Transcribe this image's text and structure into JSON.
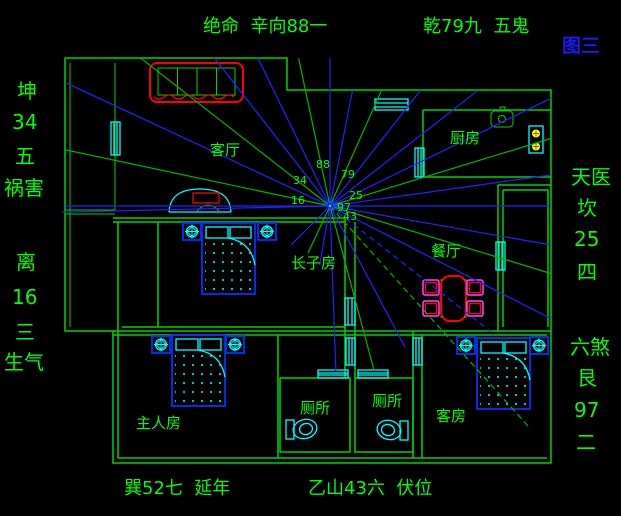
{
  "figure_tag": "图三",
  "annotations": {
    "top_left": "绝命  辛向88一",
    "top_right": "乾79九  五鬼",
    "left_top": [
      "坤",
      "34",
      "五",
      "祸害"
    ],
    "left_bottom": [
      "离",
      "16",
      "三",
      "生气"
    ],
    "right_top": [
      "天医",
      "坎",
      "25",
      "四"
    ],
    "right_bottom": [
      "六煞",
      "艮",
      "97",
      "二"
    ],
    "bottom_left": "巽52七  延年",
    "bottom_right": "乙山43六  伏位"
  },
  "rooms": {
    "living_room": "客厅",
    "kitchen": "厨房",
    "dining_room": "餐厅",
    "eldest_son_room": "长子房",
    "master_bedroom": "主人房",
    "toilet_left": "厕所",
    "toilet_right": "厕所",
    "guest_room": "客房"
  },
  "center_numbers": {
    "top": "88",
    "top_right": "79",
    "left_upper": "34",
    "right": "25",
    "left_lower": "16",
    "lower_right": "97",
    "bottom": "43"
  },
  "colors": {
    "background": "#000000",
    "wall_green": "#00d400",
    "text_green": "#00ff00",
    "ray_blue": "#2222ff",
    "ray_green": "#00b400",
    "furniture_blue": "#0033ff",
    "detail_cyan": "#00ffff",
    "accent_red": "#ff0000",
    "accent_magenta": "#ff44ff",
    "burner_yellow": "#ffff00",
    "figure_tag_blue": "#1a1aee"
  }
}
